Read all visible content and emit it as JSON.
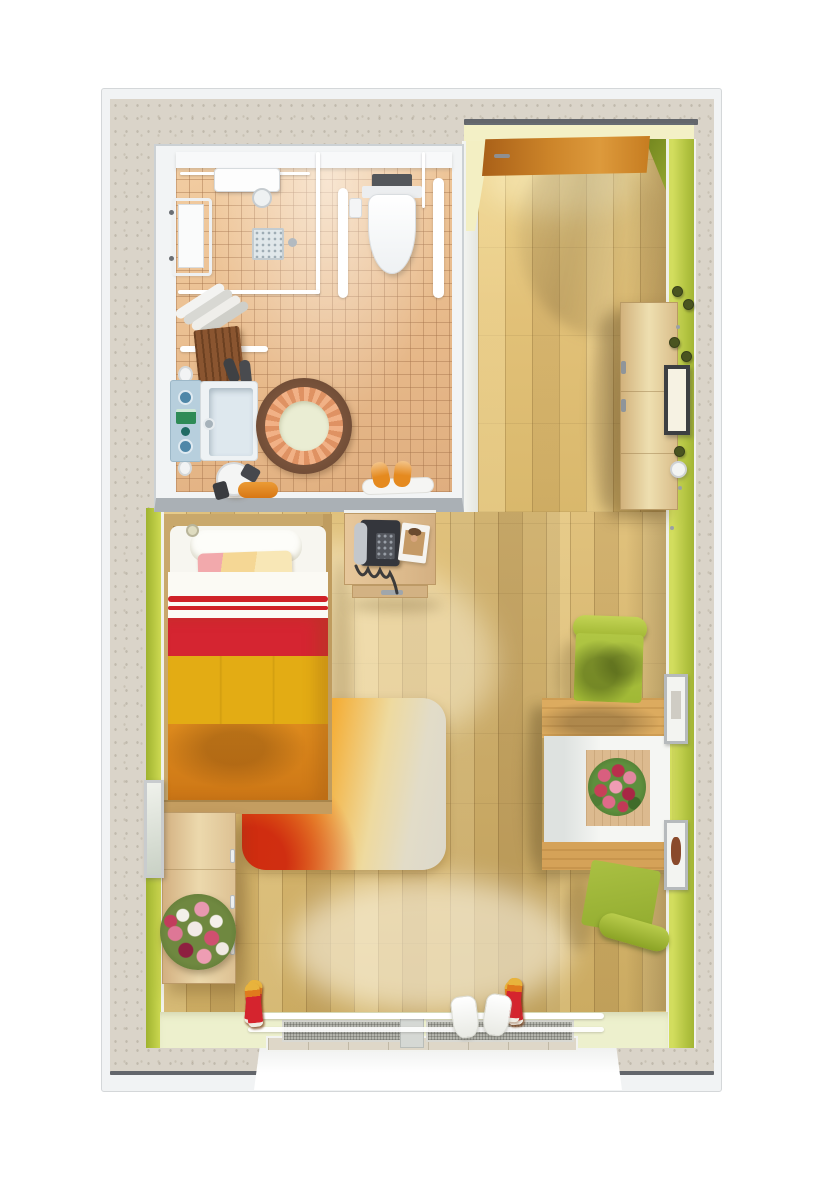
{
  "scene": {
    "kind": "3d-rendered-floor-plan",
    "view": "top-down",
    "background": "#ffffff"
  },
  "palette": {
    "concrete": "#dad4c9",
    "walledge": "#4d525a",
    "cream": "#f3f0c6",
    "greenwall": "#c3d14e",
    "palefloor": "#edf0cd",
    "tile": "#ecc192",
    "wood_entry": "#e4c47c",
    "wood_bedroom": "#dcbd76",
    "door_wood": "#cc8429",
    "cabinet_wood": "#e8d6a6",
    "bed_red": "#d52531",
    "bed_yellow": "#e3ac14",
    "bed_orange": "#dd8a1d",
    "rug_red": "#d8471c",
    "rug_orange": "#ee8d13",
    "rug_pale": "#dfdacc",
    "chair_green": "#a8bf3c",
    "vanity_blue": "#b7cfdd",
    "towel_orange": "#e0841c",
    "slipper_red": "#d5242e",
    "slipper_yellow": "#e8b33c"
  },
  "rooms": {
    "bathroom": {
      "name": "bathroom",
      "floor": "terracotta-tile",
      "items": [
        "shower-unit",
        "shower-curtain-rail",
        "floor-drain",
        "fold-seat",
        "towel-shelf",
        "grab-bars",
        "wall-hung-toilet",
        "toilet-paper-holder",
        "wood-stool",
        "wash-basin",
        "vanity-cabinet",
        "round-scalloped-rug",
        "round-stool",
        "orange-towel",
        "bath-mat",
        "slippers"
      ]
    },
    "entry": {
      "name": "entry-hall",
      "floor": "oak-planks",
      "items": [
        "entry-door-open",
        "tall-cabinet",
        "coat-hooks",
        "wall-board",
        "wall-clock-dot"
      ]
    },
    "bedroom": {
      "name": "bedroom",
      "floor": "oak-planks",
      "items": [
        "single-bed",
        "striped-blanket",
        "phone-desk",
        "telephone",
        "magazine",
        "gradient-rug",
        "sideboard",
        "flower-bouquet",
        "wall-mirror"
      ]
    },
    "living": {
      "name": "living-corner",
      "floor": "oak-planks",
      "items": [
        "dining-table",
        "table-runner",
        "rose-bouquet",
        "green-chair-top",
        "green-chair-bottom",
        "wall-picture-top",
        "wall-picture-bottom"
      ]
    },
    "balcony_window": {
      "name": "balcony-window",
      "items": [
        "shoe-rack-rails",
        "mesh-doormat-left",
        "mesh-doormat-right",
        "marble-threshold",
        "white-sill"
      ]
    }
  },
  "window": {
    "shoe_rows": [
      {
        "side": "left",
        "count": 6
      },
      {
        "side": "right",
        "count": 7
      }
    ],
    "white_slipper_count": 2
  }
}
